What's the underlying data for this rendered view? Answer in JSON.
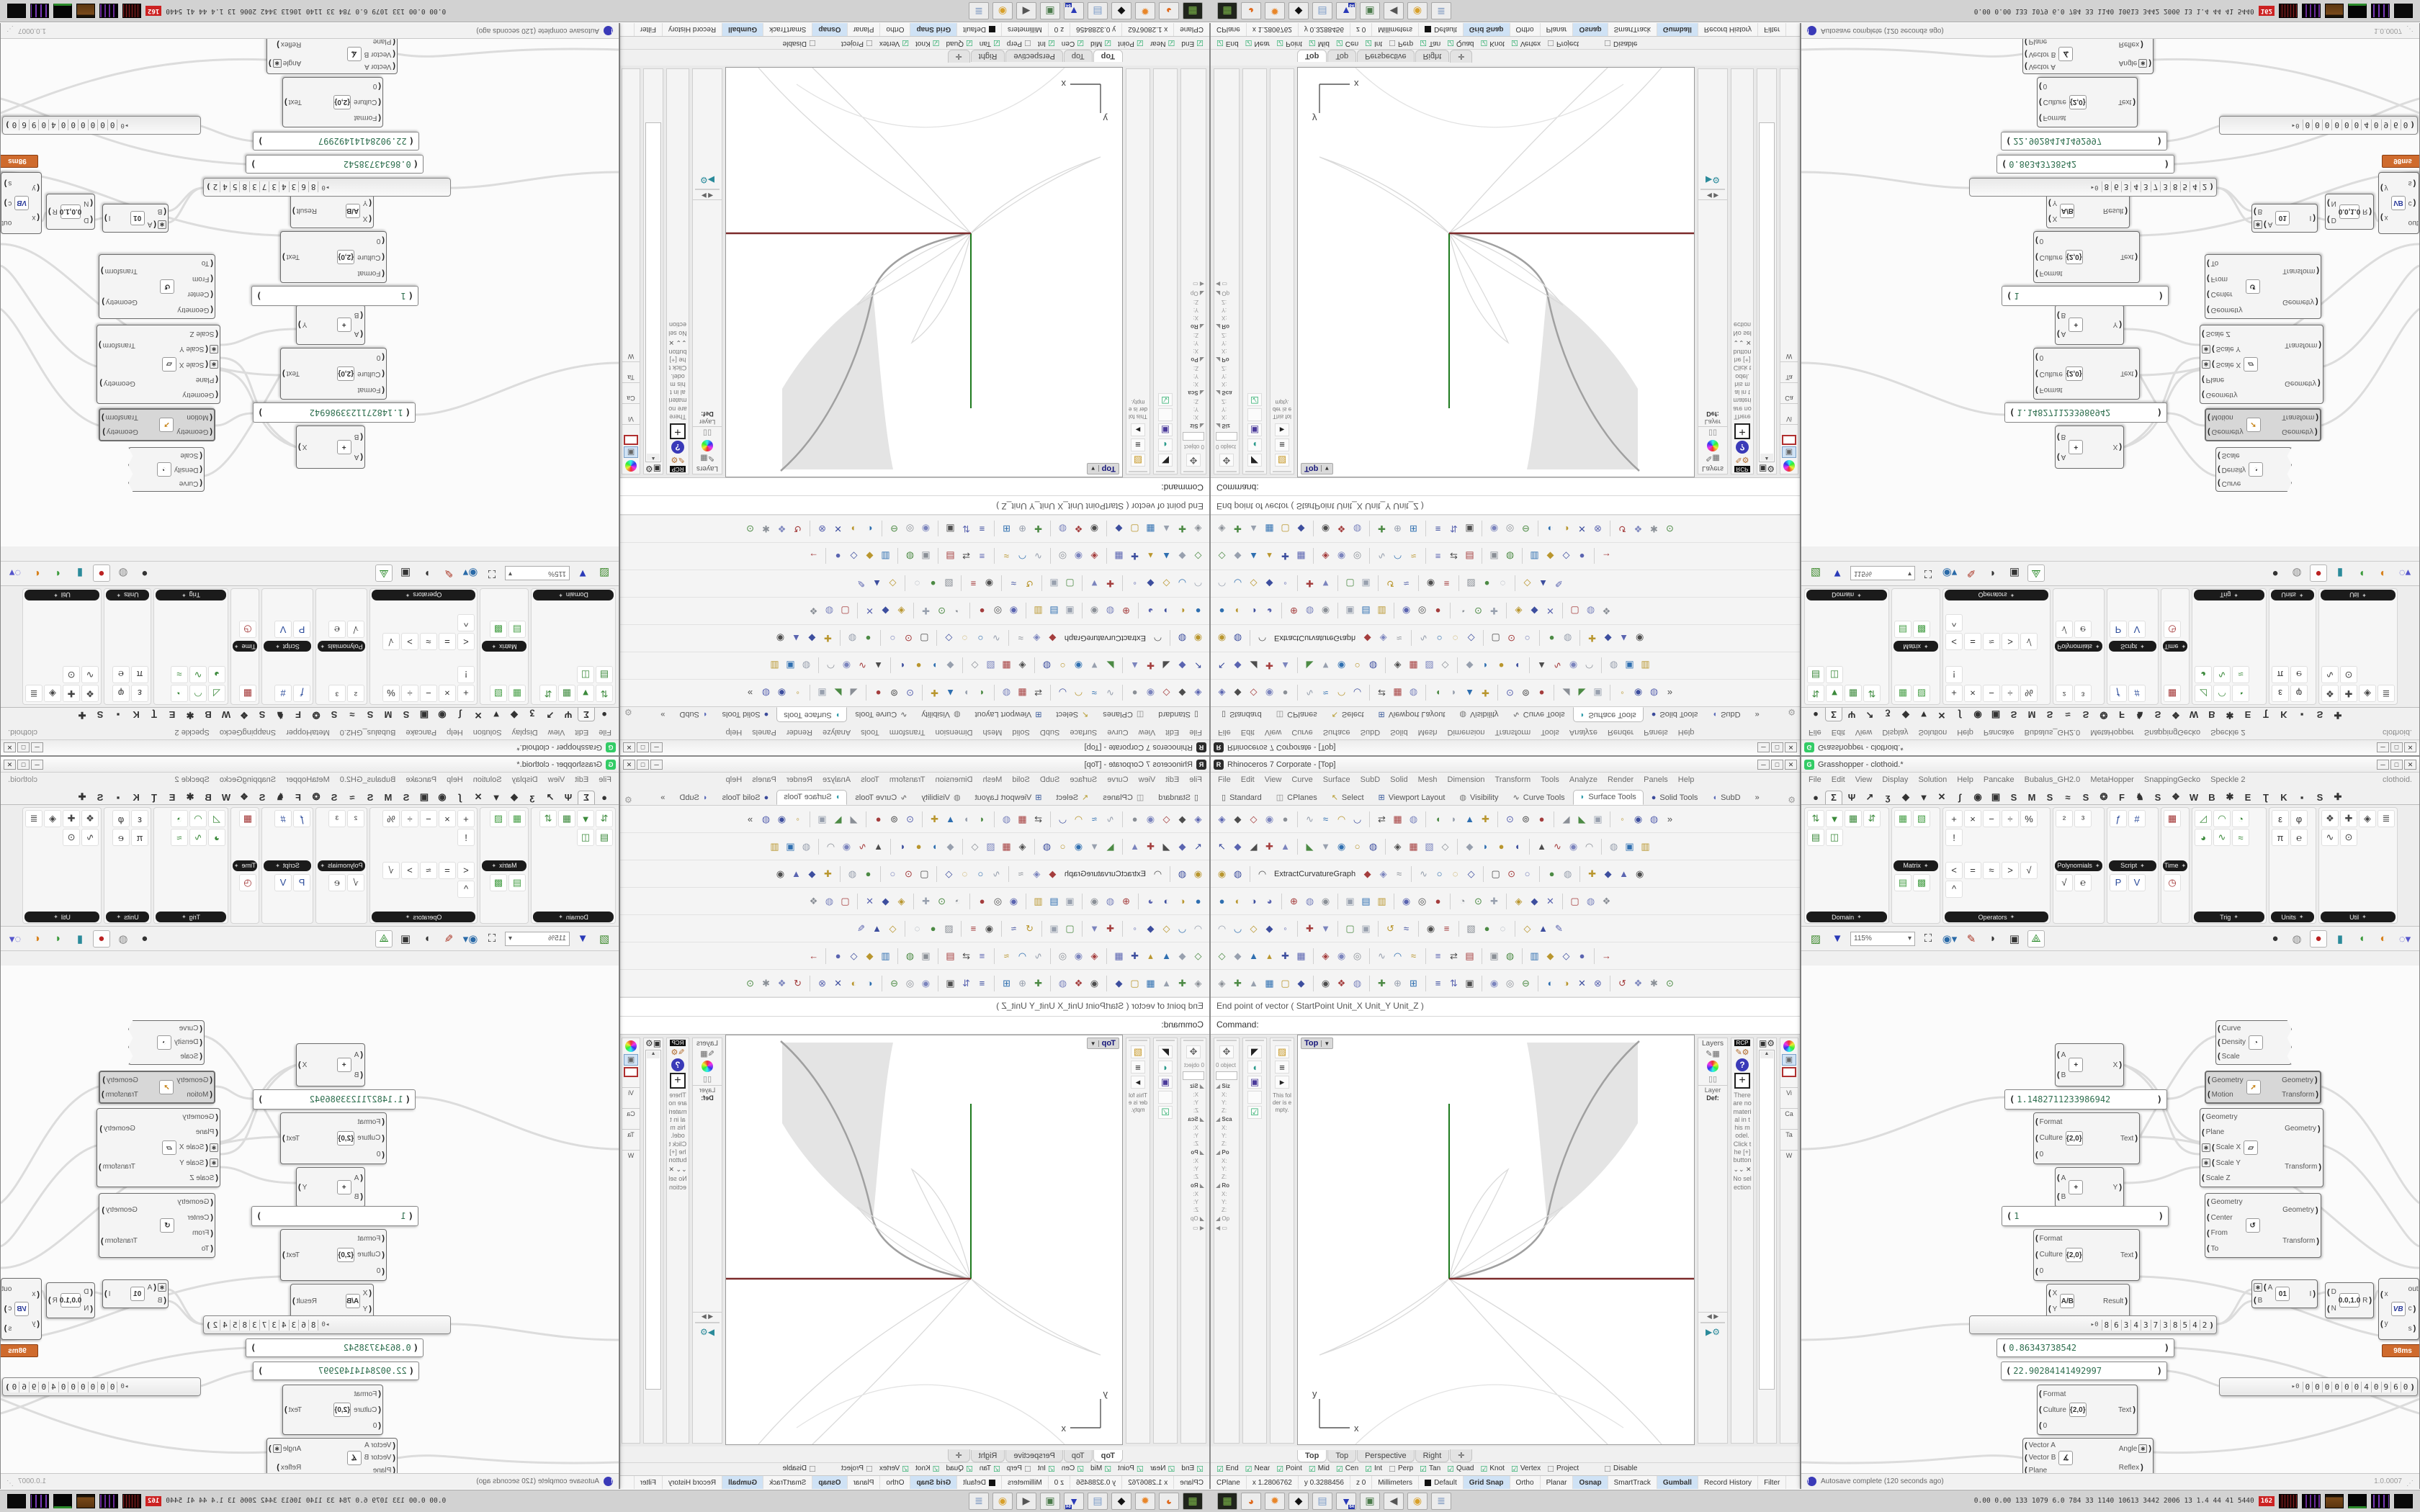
{
  "layout_note": "2x2 mirrored tiling of one 1680x1050 desktop capture",
  "colors": {
    "axis_green": "#1e7a1e",
    "line_dark_red": "#7c2b2b",
    "petal_fill": "#e4e4e4",
    "petal_edge": "#a0a0a0",
    "wire_gray": "#dcdcdc",
    "gh_value_green": "#2f6f4f",
    "active_toggle_blue": "#cfe2f5",
    "profiler_badge_orange": "#cf6b2d",
    "stat_badge_red": "#cc2222"
  },
  "rhino": {
    "title": "Rhinoceros 7 Corporate - [Top]",
    "window_buttons": [
      "─",
      "□",
      "✕"
    ],
    "menu": [
      "File",
      "Edit",
      "View",
      "Curve",
      "Surface",
      "SubD",
      "Solid",
      "Mesh",
      "Dimension",
      "Transform",
      "Tools",
      "Analyze",
      "Render",
      "Panels",
      "Help"
    ],
    "tabs": [
      {
        "label": "Standard",
        "g": "▯",
        "c": "#555"
      },
      {
        "label": "CPlanes",
        "g": "◫",
        "c": "#888"
      },
      {
        "label": "Select",
        "g": "↖",
        "c": "#b59a2a"
      },
      {
        "label": "Viewport Layout",
        "g": "⊞",
        "c": "#3a5a9a"
      },
      {
        "label": "Visibility",
        "g": "◍",
        "c": "#777"
      },
      {
        "label": "Curve Tools",
        "g": "∿",
        "c": "#555"
      },
      {
        "label": "Surface Tools",
        "g": "◗",
        "c": "#2a9aa8",
        "active": true
      },
      {
        "label": "Solid Tools",
        "g": "●",
        "c": "#3a4a9a"
      },
      {
        "label": "SubD",
        "g": "◖",
        "c": "#5a6ab8"
      },
      {
        "label": "»",
        "g": "",
        "c": "#333"
      }
    ],
    "toolbar_rows": [
      "◈◆◇◉● ∿≈◠◡ ⇄▦◍ ◖◗▲✚ ⊙⊚● ◢◣▣ ◦◉◍»",
      "↖◆◢✚▲ ◣▼◉○◍ ◈▦▧◇ ◆◗●◖ ▲∿◉◠ ◍▣▥",
      "◉◍ ◠◆◈≈ ∿○◌◇ ▢⊙○ ●◍ ✚◆▲◉",
      "●◐◑◕ ⊕◍◉ ▣▤▥ ◉◎● ◔⊙✚ ◈◆✕ ▢◍❖",
      "◠◡◇◆◦ ✚▼ ▢▣ ↺≈ ◉≡ ▧●◌ ◇▲✎",
      "◇◆▲▴✚▦ ◈◉◎ ∿◠≈ ≡⇄▤ ▣◍ ▥◆◇● →",
      "◈✚▲▦▢◆ ◉❖◍ ✚⊕⊞ ≡⇅▣ ◉◎⊖ ◐◑✕⊗ ↺❖✱⊙"
    ],
    "extract_label": "ExtractCurvatureGraph",
    "command_history": "End point of vector ( StartPoint  Unit_X  Unit_Y  Unit_Z )",
    "command_prompt": "Command:",
    "left_panels": {
      "objects_label": "0 object",
      "sections": [
        "Siz",
        "Sca",
        "Po",
        "Ro"
      ],
      "axis_labels": [
        "X:",
        "Y:",
        "Z:"
      ],
      "more_label": "Op",
      "folder_empty": "This folder is empty."
    },
    "viewport": {
      "label": "Top",
      "x_axis": "x",
      "y_axis": "y"
    },
    "right_panels": {
      "layers_title": "Layers",
      "layer_col": "Layer",
      "layer_default": "Def:",
      "rcp_tag": "RCP",
      "materials_note": "There are no material in this model. Click the [+] button",
      "no_selection": "No selection",
      "props_labels": [
        "Vi",
        "Ca",
        "Ta",
        "W"
      ]
    },
    "vp_tabs": [
      {
        "label": "Top",
        "active": true
      },
      {
        "label": "Top"
      },
      {
        "label": "Perspective"
      },
      {
        "label": "Right"
      },
      {
        "label": "✛"
      }
    ],
    "osnap": [
      [
        "End",
        1
      ],
      [
        "Near",
        1
      ],
      [
        "Point",
        1
      ],
      [
        "Mid",
        1
      ],
      [
        "Cen",
        1
      ],
      [
        "Int",
        1
      ],
      [
        "Perp",
        0
      ],
      [
        "Tan",
        1
      ],
      [
        "Quad",
        1
      ],
      [
        "Knot",
        1
      ],
      [
        "Vertex",
        1
      ],
      [
        "Project",
        0
      ],
      [
        "Disable",
        0
      ]
    ],
    "status": [
      {
        "t": "CPlane"
      },
      {
        "t": "x 1.2806762"
      },
      {
        "t": "y 0.3288456"
      },
      {
        "t": "z 0"
      },
      {
        "t": "Millimeters"
      },
      {
        "t": "Default",
        "swatch": true
      },
      {
        "t": "Grid Snap",
        "on": true
      },
      {
        "t": "Ortho"
      },
      {
        "t": "Planar"
      },
      {
        "t": "Osnap",
        "on": true
      },
      {
        "t": "SmartTrack"
      },
      {
        "t": "Gumball",
        "on": true
      },
      {
        "t": "Record History"
      },
      {
        "t": "Filter"
      }
    ]
  },
  "grasshopper": {
    "title": "Grasshopper - clothoid.*",
    "doc_label": "clothoid.",
    "window_buttons": [
      "─",
      "□",
      "✕"
    ],
    "menu": [
      "File",
      "Edit",
      "View",
      "Display",
      "Solution",
      "Help",
      "Pancake",
      "Bubalus_GH2.0",
      "MetaHopper",
      "SnappingGecko",
      "Speckle 2"
    ],
    "tabs": [
      "●",
      "Σ",
      "Ψ",
      "↗",
      "ʒ",
      "◆",
      "▼",
      "✕",
      "ʃ",
      "◉",
      "▣",
      "S",
      "M",
      "S",
      "≈",
      "S",
      "❂",
      "F",
      "♞",
      "S",
      "❖",
      "W",
      "B",
      "✱",
      "E",
      "Ʈ",
      "K",
      "▪",
      "S",
      "✚"
    ],
    "active_tab_index": 1,
    "ribbon": [
      {
        "name": "Domain",
        "pos": "bottom",
        "w": 118,
        "icons": "⇅▼▦⇵▤◫",
        "ic": "#3c8a3c"
      },
      {
        "name": "Matrix",
        "pos": "mid",
        "w": 68,
        "icons": "▦▧",
        "icons2": "▤▩",
        "ic": "#49a049"
      },
      {
        "name": "Operators",
        "pos": "bottom",
        "w": 150,
        "icons": "+×−÷%!",
        "icons2": "<=≈>√^",
        "ic": "#333"
      },
      {
        "name": "Polynomials",
        "pos": "mid",
        "w": 72,
        "icons": "²³",
        "icons2": "√℮",
        "ic": "#333"
      },
      {
        "name": "Script",
        "pos": "mid",
        "w": 72,
        "icons": "ƒ#",
        "icons2": "PV",
        "ic": "#2a4a9a"
      },
      {
        "name": "Time",
        "pos": "mid",
        "w": 40,
        "icons": "▦",
        "icons2": "◷",
        "ic": "#a03030"
      },
      {
        "name": "Trig",
        "pos": "bottom",
        "w": 104,
        "icons": "◿◠◔◕∿≈",
        "ic": "#3c8a3c"
      },
      {
        "name": "Units",
        "pos": "bottom",
        "w": 66,
        "icons": "εφπ℮",
        "ic": "#333"
      },
      {
        "name": "Util",
        "pos": "bottom",
        "w": 110,
        "icons": "❖✚◈≣∿⊙",
        "ic": "#444"
      }
    ],
    "toolbar": {
      "zoom": "115%"
    },
    "status_left": "Autosave complete (120 seconds ago)",
    "status_right": "1.0.0007",
    "canvas": {
      "panel_a": "1.1482711233986942",
      "panel_b": "1",
      "panel_c": "0.86343738542",
      "panel_d": "22.90284141492997",
      "slider_prefix": "▸0",
      "slider1_digits": [
        "8",
        "6",
        "3",
        "4",
        "3",
        "7",
        "3",
        "8",
        "5",
        "4",
        "2"
      ],
      "slider2_digits": [
        "0",
        "0",
        "0",
        "0",
        "0",
        "0",
        "4",
        "0",
        "9",
        "6",
        "0"
      ],
      "format_node": {
        "ins": [
          "Format",
          "Culture",
          "0"
        ],
        "outs": [
          "Text"
        ],
        "icon": "{2,0}"
      },
      "add_x": {
        "ins": [
          "A",
          "B"
        ],
        "outs": [
          "X"
        ],
        "icon": "+"
      },
      "add_y": {
        "ins": [
          "A",
          "B"
        ],
        "outs": [
          "Y"
        ],
        "icon": "+"
      },
      "division": {
        "ins": [
          "X",
          "Y"
        ],
        "outs": [
          "Result"
        ],
        "icon": "A/B"
      },
      "spiral": {
        "ins": [
          "Curve",
          "Density",
          "Scale"
        ],
        "outs": [],
        "icon": "◔"
      },
      "move": {
        "ins": [
          "Geometry",
          "Motion"
        ],
        "outs": [
          "Geometry",
          "Transform"
        ],
        "icon": "➚"
      },
      "scale_nu": {
        "ins": [
          "Geometry",
          "Plane",
          "Scale X",
          "Scale Y",
          "Scale Z"
        ],
        "outs": [
          "Geometry",
          "Transform"
        ],
        "icon": "▱",
        "stars": [
          2,
          3
        ]
      },
      "rotate": {
        "ins": [
          "Geometry",
          "Center",
          "From",
          "To"
        ],
        "outs": [
          "Geometry",
          "Transform"
        ],
        "icon": "↺"
      },
      "gate": {
        "ins": [
          "A",
          "B"
        ],
        "outs": [
          "I"
        ],
        "icon": "01",
        "stars": [
          0
        ]
      },
      "remap": {
        "ins": [
          "D",
          "N"
        ],
        "outs": [
          "R"
        ],
        "icon": "0.0,1.0"
      },
      "vb": {
        "ins": [
          "x",
          "y"
        ],
        "outs": [
          "out",
          "c",
          "s"
        ],
        "icon": "VB",
        "badge": "98ms"
      },
      "angle": {
        "ins": [
          "Vector A",
          "Vector B",
          "Plane"
        ],
        "outs": [
          "Angle",
          "Reflex"
        ],
        "icon": "∡",
        "out_star": 0
      }
    }
  },
  "desktop": {
    "dock_icons": [
      {
        "name": "pad-icon",
        "g": "▦",
        "c": "#7ab648",
        "bg": "#20241c"
      },
      {
        "name": "firefox-icon",
        "g": "◕",
        "c": "#e06a1e"
      },
      {
        "name": "blender-icon",
        "g": "✹",
        "c": "#e8862a"
      },
      {
        "name": "rhino-icon",
        "g": "◆",
        "c": "#111"
      },
      {
        "name": "notepad-icon",
        "g": "▤",
        "c": "#7a9ac8"
      },
      {
        "name": "floppy-icon",
        "g": "▼",
        "c": "#2a3ab8",
        "sub": "64"
      },
      {
        "name": "display-icon",
        "g": "▣",
        "c": "#4a7a4a"
      },
      {
        "name": "speaker-icon",
        "g": "◀",
        "c": "#555"
      },
      {
        "name": "chrome-icon",
        "g": "◉",
        "c": "#d8a02a"
      },
      {
        "name": "scroll-icon",
        "g": "≣",
        "c": "#6a8ab8"
      }
    ],
    "stats_numbers": "0.00 0.00  133 1079 6.0  784   33  1140 10613 3442 2006  13   1.4   44    41  5440",
    "stats_badge": "162"
  }
}
